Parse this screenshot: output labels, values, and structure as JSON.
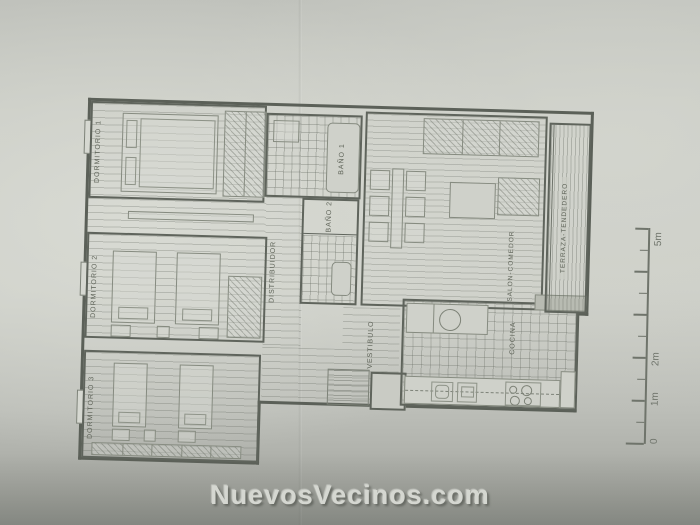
{
  "photo": {
    "watermark": "NuevosVecinos.com"
  },
  "plan": {
    "rooms": {
      "dormitorio_1": "DORMITORIO 1",
      "dormitorio_2": "DORMITORIO 2",
      "dormitorio_3": "DORMITORIO 3",
      "distribuidor": "DISTRIBUIDOR",
      "bano_1": "BAÑO 1",
      "bano_2": "BAÑO 2",
      "vestibulo": "VESTIBULO",
      "salon_comedor": "SALON-COMEDOR",
      "cocina": "COCINA",
      "terraza": "TERRAZA-TENDEDERO"
    },
    "scale_bar": {
      "zero": "0",
      "one_m": "1m",
      "two_m": "2m",
      "five_m": "5m"
    }
  },
  "colors": {
    "paper": "#c9cbc4",
    "ink": "#5f645c",
    "shadow_band": "#9da09a",
    "watermark_fill": "#d5d7d1"
  }
}
